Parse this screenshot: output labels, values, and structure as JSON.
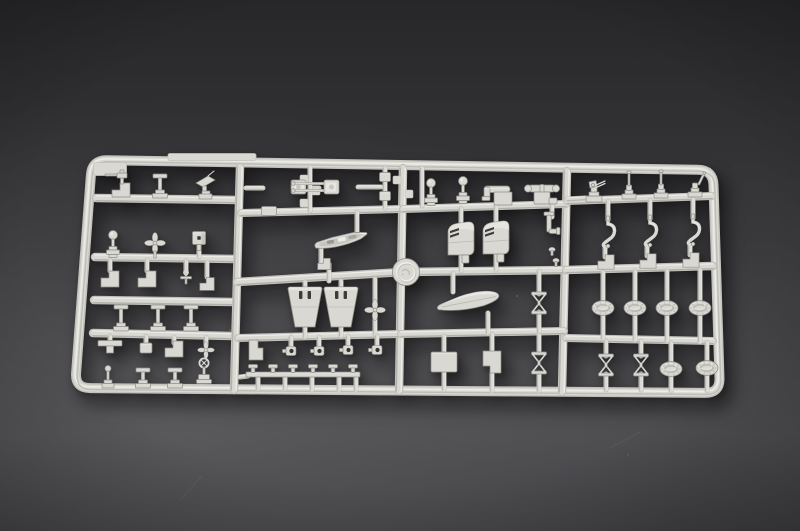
{
  "meta": {
    "subject": "Light grey injection-molded model kit sprue (parts tree) of small warship fittings photographed on a dark grey studio background",
    "objects": "runner frame, ship's boats, funnels, twin gun barrels, davit hooks, life-raft ovals, searchlights, winches, turnbuckle cross-frames, propellers, bollard strip, round maker disc"
  },
  "scene": {
    "colors": {
      "edge": "#c2c1bb",
      "face": "#d9d8d3",
      "hi": "#efeee9",
      "lo": "#a7a6a0",
      "dark": "#b3b2ac",
      "deep": "#8f8e88",
      "slot": "#3c3c3a",
      "hole": "#343432",
      "bgTop": "#27272a",
      "bgMid": "#39393c",
      "bgLow": "#4d4d50",
      "bgBot": "#414144"
    },
    "frame": {
      "corners": [
        [
          92,
          160
        ],
        [
          713,
          170
        ],
        [
          720,
          393
        ],
        [
          75,
          388
        ]
      ],
      "radius": 15,
      "width": 10
    },
    "rails": [
      [
        96,
        198,
        238,
        200,
        8.5
      ],
      [
        95,
        257,
        236,
        259,
        8.5
      ],
      [
        94,
        300,
        234,
        302,
        8.5
      ],
      [
        93,
        333,
        233,
        336,
        8.5
      ],
      [
        240,
        167,
        234,
        390,
        8.5
      ],
      [
        403,
        168,
        399,
        391,
        8.5
      ],
      [
        567,
        171,
        562,
        392,
        8.5
      ],
      [
        241,
        213,
        401,
        209,
        8
      ],
      [
        237,
        282,
        403,
        272,
        8.5
      ],
      [
        403,
        272,
        566,
        270,
        8.5
      ],
      [
        566,
        270,
        713,
        266,
        8.5
      ],
      [
        238,
        338,
        400,
        334,
        8
      ],
      [
        403,
        209,
        566,
        204,
        8
      ],
      [
        401,
        334,
        564,
        331,
        8
      ],
      [
        567,
        201,
        712,
        196,
        8
      ],
      [
        566,
        338,
        713,
        341,
        8
      ]
    ],
    "stubs": [
      [
        246,
        188,
        263,
        188
      ],
      [
        313,
        188,
        319,
        188
      ],
      [
        358,
        187,
        381,
        187
      ],
      [
        310,
        167,
        310,
        211
      ],
      [
        385,
        168,
        385,
        208
      ],
      [
        357,
        212,
        357,
        233
      ],
      [
        321,
        248,
        321,
        262
      ],
      [
        329,
        264,
        329,
        281
      ],
      [
        305,
        282,
        305,
        290
      ],
      [
        341,
        281,
        341,
        289
      ],
      [
        305,
        326,
        305,
        337
      ],
      [
        341,
        325,
        341,
        336
      ],
      [
        375,
        279,
        375,
        302
      ],
      [
        375,
        318,
        375,
        334
      ],
      [
        110,
        260,
        110,
        271
      ],
      [
        147,
        260,
        147,
        271
      ],
      [
        186,
        261,
        186,
        273
      ],
      [
        207,
        262,
        207,
        277
      ],
      [
        110,
        336,
        110,
        341
      ],
      [
        146,
        336,
        146,
        342
      ],
      [
        174,
        337,
        174,
        343
      ],
      [
        206,
        337,
        206,
        345
      ],
      [
        291,
        337,
        291,
        346
      ],
      [
        319,
        337,
        319,
        346
      ],
      [
        348,
        336,
        348,
        345
      ],
      [
        377,
        336,
        377,
        345
      ],
      [
        258,
        377,
        258,
        389
      ],
      [
        285,
        376,
        285,
        389
      ],
      [
        312,
        376,
        312,
        390
      ],
      [
        339,
        375,
        339,
        390
      ],
      [
        356,
        375,
        356,
        390
      ],
      [
        240,
        377,
        248,
        376
      ],
      [
        199,
        244,
        199,
        257
      ],
      [
        422,
        168,
        422,
        206
      ],
      [
        461,
        208,
        461,
        224
      ],
      [
        461,
        256,
        461,
        271
      ],
      [
        496,
        206,
        496,
        223
      ],
      [
        496,
        255,
        496,
        270
      ],
      [
        552,
        205,
        552,
        217
      ],
      [
        453,
        273,
        453,
        292
      ],
      [
        488,
        313,
        488,
        333
      ],
      [
        539,
        271,
        539,
        294
      ],
      [
        539,
        312,
        539,
        332
      ],
      [
        539,
        335,
        539,
        353
      ],
      [
        539,
        373,
        539,
        391
      ],
      [
        444,
        336,
        444,
        352
      ],
      [
        444,
        372,
        444,
        390
      ],
      [
        492,
        334,
        492,
        351
      ],
      [
        492,
        373,
        492,
        391
      ],
      [
        567,
        199,
        586,
        198
      ],
      [
        608,
        201,
        608,
        220
      ],
      [
        650,
        200,
        650,
        219
      ],
      [
        693,
        199,
        693,
        218
      ],
      [
        605,
        248,
        605,
        257
      ],
      [
        647,
        247,
        647,
        256
      ],
      [
        690,
        246,
        690,
        255
      ],
      [
        603,
        272,
        603,
        301
      ],
      [
        603,
        315,
        603,
        339
      ],
      [
        635,
        271,
        635,
        301
      ],
      [
        635,
        315,
        635,
        340
      ],
      [
        667,
        271,
        667,
        301
      ],
      [
        667,
        315,
        667,
        341
      ],
      [
        700,
        270,
        700,
        301
      ],
      [
        700,
        315,
        700,
        342
      ],
      [
        606,
        341,
        606,
        356
      ],
      [
        606,
        374,
        606,
        390
      ],
      [
        641,
        341,
        641,
        356
      ],
      [
        641,
        374,
        641,
        390
      ],
      [
        671,
        343,
        671,
        362
      ],
      [
        671,
        376,
        671,
        391
      ],
      [
        707,
        342,
        707,
        361
      ],
      [
        707,
        375,
        707,
        391
      ]
    ],
    "nubs": [
      [
        310,
        179,
        -1
      ],
      [
        310,
        191,
        1
      ],
      [
        310,
        203,
        -1
      ],
      [
        403,
        180,
        -1
      ],
      [
        403,
        194,
        1
      ]
    ],
    "parts": [
      {
        "t": "tab",
        "x": 110,
        "y": 169,
        "w": 33,
        "h": 13
      },
      {
        "t": "tab",
        "x": 212,
        "y": 157,
        "w": 88,
        "h": 7
      },
      {
        "t": "pedestal_gun",
        "x": 122,
        "y": 189
      },
      {
        "t": "post_T",
        "x": 160,
        "y": 186,
        "h": 24
      },
      {
        "t": "angled_plate",
        "x": 205,
        "y": 186
      },
      {
        "t": "searchlight",
        "x": 113,
        "y": 247
      },
      {
        "t": "propeller",
        "x": 155,
        "y": 243,
        "stem": 1
      },
      {
        "t": "cube",
        "x": 199,
        "y": 238
      },
      {
        "t": "step_block",
        "x": 110,
        "y": 279
      },
      {
        "t": "step_block",
        "x": 147,
        "y": 279
      },
      {
        "t": "cross_small",
        "x": 186,
        "y": 281
      },
      {
        "t": "step_block",
        "x": 207,
        "y": 284,
        "s": 0.8
      },
      {
        "t": "post_T",
        "x": 121,
        "y": 318,
        "h": 26
      },
      {
        "t": "post_T",
        "x": 158,
        "y": 318,
        "h": 26
      },
      {
        "t": "post_T",
        "x": 191,
        "y": 318,
        "h": 26
      },
      {
        "t": "wide_T",
        "x": 110,
        "y": 346
      },
      {
        "t": "block",
        "x": 146,
        "y": 348,
        "w": 12,
        "h": 10
      },
      {
        "t": "step_block",
        "x": 174,
        "y": 349
      },
      {
        "t": "propeller",
        "x": 206,
        "y": 350,
        "s": 0.8
      },
      {
        "t": "ball_post",
        "x": 108,
        "y": 377
      },
      {
        "t": "post_T",
        "x": 143,
        "y": 378,
        "h": 20
      },
      {
        "t": "post_T",
        "x": 175,
        "y": 378,
        "h": 20
      },
      {
        "t": "valve_wheel",
        "x": 204,
        "y": 373
      },
      {
        "t": "twin_gun",
        "x": 303,
        "y": 187,
        "dir": -1
      },
      {
        "t": "twin_gun",
        "x": 327,
        "y": 187,
        "dir": 1
      },
      {
        "t": "block",
        "x": 385,
        "y": 177,
        "w": 11,
        "h": 9
      },
      {
        "t": "block",
        "x": 385,
        "y": 196,
        "w": 11,
        "h": 9
      },
      {
        "t": "block",
        "x": 269,
        "y": 211,
        "w": 15,
        "h": 9
      },
      {
        "t": "open_boat",
        "x": 341,
        "y": 241,
        "rot": -9
      },
      {
        "t": "step_block",
        "x": 324,
        "y": 264,
        "s": 0.7
      },
      {
        "t": "funnel_trap",
        "x": 305,
        "y": 307
      },
      {
        "t": "funnel_trap",
        "x": 341,
        "y": 307
      },
      {
        "t": "propeller",
        "x": 375,
        "y": 310
      },
      {
        "t": "L_block",
        "x": 256,
        "y": 350
      },
      {
        "t": "eyelet",
        "x": 291,
        "y": 351
      },
      {
        "t": "eyelet",
        "x": 319,
        "y": 351
      },
      {
        "t": "eyelet",
        "x": 348,
        "y": 350
      },
      {
        "t": "eyelet",
        "x": 377,
        "y": 350
      },
      {
        "t": "bitt_strip",
        "x": 303,
        "y": 374
      },
      {
        "t": "logo_disc",
        "x": 406,
        "y": 272
      },
      {
        "t": "searchlight",
        "x": 431,
        "y": 195
      },
      {
        "t": "searchlight",
        "x": 463,
        "y": 193
      },
      {
        "t": "duct_L",
        "x": 499,
        "y": 199
      },
      {
        "t": "windlass",
        "x": 542,
        "y": 198
      },
      {
        "t": "funnel",
        "x": 461,
        "y": 240
      },
      {
        "t": "funnel",
        "x": 496,
        "y": 239
      },
      {
        "t": "pipe_L_sm",
        "x": 549,
        "y": 226
      },
      {
        "t": "knob",
        "x": 552,
        "y": 252
      },
      {
        "t": "knob",
        "x": 556,
        "y": 263
      },
      {
        "t": "covered_boat",
        "x": 469,
        "y": 302,
        "rot": -5
      },
      {
        "t": "x_turnbuckle",
        "x": 539,
        "y": 303
      },
      {
        "t": "block",
        "x": 444,
        "y": 362,
        "w": 26,
        "h": 20
      },
      {
        "t": "block_step",
        "x": 492,
        "y": 362
      },
      {
        "t": "x_turnbuckle",
        "x": 539,
        "y": 363
      },
      {
        "t": "aa_gun",
        "x": 594,
        "y": 195
      },
      {
        "t": "gun_post",
        "x": 629,
        "y": 194
      },
      {
        "t": "gun_post",
        "x": 661,
        "y": 193
      },
      {
        "t": "gun_post",
        "x": 695,
        "y": 192,
        "slant": 1
      },
      {
        "t": "hook",
        "x": 608,
        "y": 238
      },
      {
        "t": "hook",
        "x": 650,
        "y": 237
      },
      {
        "t": "hook",
        "x": 693,
        "y": 236
      },
      {
        "t": "step_block",
        "x": 606,
        "y": 262,
        "s": 0.9
      },
      {
        "t": "step_block",
        "x": 648,
        "y": 261,
        "s": 0.9
      },
      {
        "t": "step_block",
        "x": 691,
        "y": 260,
        "s": 0.9
      },
      {
        "t": "oval_raft",
        "x": 603,
        "y": 308
      },
      {
        "t": "oval_raft",
        "x": 635,
        "y": 308
      },
      {
        "t": "oval_raft",
        "x": 667,
        "y": 308
      },
      {
        "t": "oval_raft",
        "x": 700,
        "y": 308
      },
      {
        "t": "x_turnbuckle",
        "x": 606,
        "y": 365
      },
      {
        "t": "x_turnbuckle",
        "x": 641,
        "y": 365
      },
      {
        "t": "oval_raft",
        "x": 671,
        "y": 369
      },
      {
        "t": "oval_raft",
        "x": 707,
        "y": 368
      }
    ],
    "specks": [
      [
        230,
        330,
        0.28
      ],
      [
        517,
        296,
        0.2
      ],
      [
        628,
        455,
        0.12
      ]
    ],
    "scratches": [
      [
        180,
        500,
        202,
        476
      ],
      [
        610,
        448,
        640,
        432
      ]
    ]
  }
}
